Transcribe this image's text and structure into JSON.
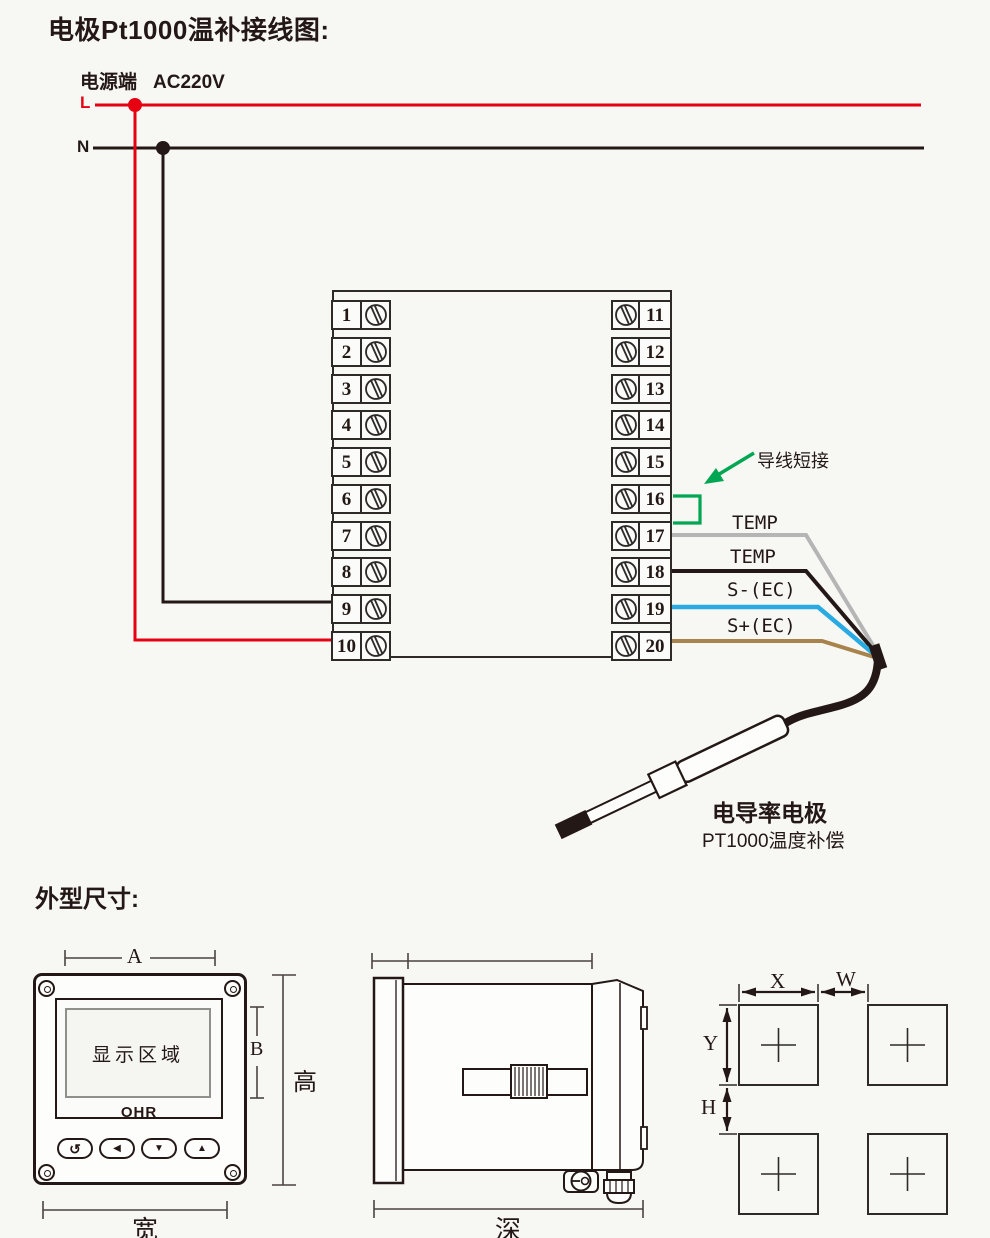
{
  "colors": {
    "red": "#e60012",
    "black": "#231815",
    "green": "#00a651",
    "gray_wire": "#b5b5b6",
    "blue_wire": "#29abe2",
    "brown_wire": "#a8834b"
  },
  "wiring": {
    "title": "电极Pt1000温补接线图:",
    "power": {
      "terminal_label": "电源端",
      "voltage": "AC220V",
      "live": "L",
      "neutral": "N"
    },
    "terminals": {
      "left": [
        "1",
        "2",
        "3",
        "4",
        "5",
        "6",
        "7",
        "8",
        "9",
        "10"
      ],
      "right": [
        "11",
        "12",
        "13",
        "14",
        "15",
        "16",
        "17",
        "18",
        "19",
        "20"
      ]
    },
    "jumper_label": "导线短接",
    "wires": [
      {
        "label": "TEMP",
        "color": "#b5b5b6",
        "terminal": "17"
      },
      {
        "label": "TEMP",
        "color": "#231815",
        "terminal": "18"
      },
      {
        "label": "S-(EC)",
        "color": "#29abe2",
        "terminal": "19"
      },
      {
        "label": "S+(EC)",
        "color": "#a8834b",
        "terminal": "20"
      }
    ],
    "electrode": {
      "name": "电导率电极",
      "subtitle": "PT1000温度补偿"
    }
  },
  "dims": {
    "heading": "外型尺寸:",
    "front": {
      "display_text": "显示区域",
      "brand": "OHR",
      "dim_a": "A",
      "dim_b": "B",
      "dim_height": "高",
      "dim_width": "宽",
      "buttons": [
        {
          "name": "loop-button",
          "icon": "↺"
        },
        {
          "name": "left-button",
          "icon": "◀"
        },
        {
          "name": "down-button",
          "icon": "▼"
        },
        {
          "name": "up-button",
          "icon": "▲"
        }
      ]
    },
    "side": {
      "dim_depth": "深"
    },
    "cutout": {
      "dim_x": "X",
      "dim_w": "W",
      "dim_y": "Y",
      "dim_h": "H"
    }
  }
}
